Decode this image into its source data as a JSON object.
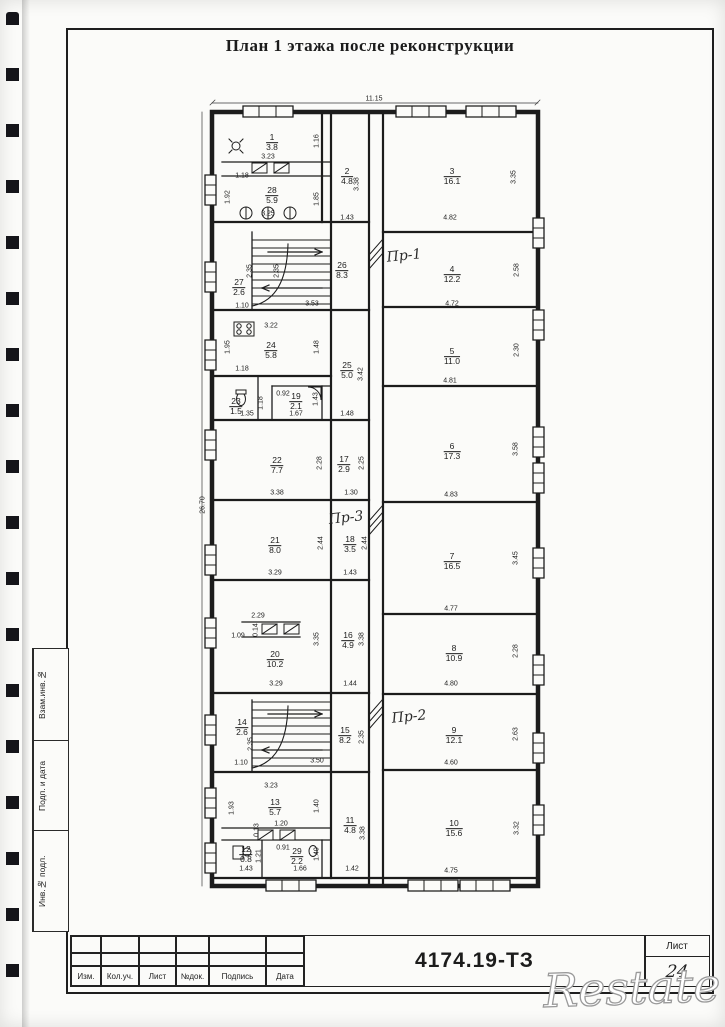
{
  "page": {
    "title": "План 1 этажа после реконструкции",
    "watermark": "Restate"
  },
  "titleblock": {
    "doc_number": "4174.19-ТЗ",
    "sheet_label": "Лист",
    "sheet_number": "24",
    "columns": [
      "Изм.",
      "Кол.уч.",
      "Лист",
      "№док.",
      "Подпись",
      "Дата"
    ]
  },
  "sidebar_stamp": {
    "labels": [
      "Взам.инв.№",
      "Подп. и дата",
      "Инв.№ подл."
    ]
  },
  "plan": {
    "overall_width_dim": "11.15",
    "overall_height_dim": "26.70",
    "annotations": [
      {
        "text": "Пр-1",
        "x": 404,
        "y": 256,
        "r": -6
      },
      {
        "text": "Пр-3",
        "x": 346,
        "y": 518,
        "r": -6
      },
      {
        "text": "Пр-2",
        "x": 409,
        "y": 717,
        "r": -6
      }
    ],
    "rooms": [
      {
        "n": "1",
        "a": "3.8",
        "x": 272,
        "y": 143
      },
      {
        "n": "2",
        "a": "4.8",
        "x": 347,
        "y": 177
      },
      {
        "n": "3",
        "a": "16.1",
        "x": 452,
        "y": 177
      },
      {
        "n": "28",
        "a": "5.9",
        "x": 272,
        "y": 196
      },
      {
        "n": "27",
        "a": "2.6",
        "x": 239,
        "y": 288
      },
      {
        "n": "26",
        "a": "8.3",
        "x": 342,
        "y": 271
      },
      {
        "n": "4",
        "a": "12.2",
        "x": 452,
        "y": 275
      },
      {
        "n": "24",
        "a": "5.8",
        "x": 271,
        "y": 351
      },
      {
        "n": "25",
        "a": "5.0",
        "x": 347,
        "y": 371
      },
      {
        "n": "5",
        "a": "11.0",
        "x": 452,
        "y": 357
      },
      {
        "n": "23",
        "a": "1.5",
        "x": 236,
        "y": 407
      },
      {
        "n": "19",
        "a": "2.1",
        "x": 296,
        "y": 402
      },
      {
        "n": "22",
        "a": "7.7",
        "x": 277,
        "y": 466
      },
      {
        "n": "17",
        "a": "2.9",
        "x": 344,
        "y": 465
      },
      {
        "n": "6",
        "a": "17.3",
        "x": 452,
        "y": 452
      },
      {
        "n": "21",
        "a": "8.0",
        "x": 275,
        "y": 546
      },
      {
        "n": "18",
        "a": "3.5",
        "x": 350,
        "y": 545
      },
      {
        "n": "7",
        "a": "16.5",
        "x": 452,
        "y": 562
      },
      {
        "n": "20",
        "a": "10.2",
        "x": 275,
        "y": 660
      },
      {
        "n": "16",
        "a": "4.9",
        "x": 348,
        "y": 641
      },
      {
        "n": "8",
        "a": "10.9",
        "x": 454,
        "y": 654
      },
      {
        "n": "14",
        "a": "2.6",
        "x": 242,
        "y": 728
      },
      {
        "n": "15",
        "a": "8.2",
        "x": 345,
        "y": 736
      },
      {
        "n": "9",
        "a": "12.1",
        "x": 454,
        "y": 736
      },
      {
        "n": "13",
        "a": "5.7",
        "x": 275,
        "y": 808
      },
      {
        "n": "11",
        "a": "4.8",
        "x": 350,
        "y": 826
      },
      {
        "n": "12",
        "a": "0.8",
        "x": 246,
        "y": 855
      },
      {
        "n": "29",
        "a": "2.2",
        "x": 297,
        "y": 857
      },
      {
        "n": "10",
        "a": "15.6",
        "x": 454,
        "y": 829
      }
    ],
    "dims": [
      {
        "t": "11.15",
        "x": 374,
        "y": 99
      },
      {
        "t": "26.70",
        "x": 203,
        "y": 505,
        "r": -90
      },
      {
        "t": "3.23",
        "x": 268,
        "y": 157
      },
      {
        "t": "1.16",
        "x": 317,
        "y": 141,
        "r": -90
      },
      {
        "t": "1.18",
        "x": 242,
        "y": 176
      },
      {
        "t": "1.92",
        "x": 228,
        "y": 197,
        "r": -90
      },
      {
        "t": "1.85",
        "x": 317,
        "y": 199,
        "r": -90
      },
      {
        "t": "3.25",
        "x": 268,
        "y": 214
      },
      {
        "t": "3.38",
        "x": 357,
        "y": 184,
        "r": -90
      },
      {
        "t": "1.43",
        "x": 347,
        "y": 218
      },
      {
        "t": "4.82",
        "x": 450,
        "y": 218
      },
      {
        "t": "3.35",
        "x": 514,
        "y": 177,
        "r": -90
      },
      {
        "t": "2.35",
        "x": 250,
        "y": 271,
        "r": -90
      },
      {
        "t": "2.35",
        "x": 277,
        "y": 271,
        "r": -90
      },
      {
        "t": "1.10",
        "x": 242,
        "y": 306
      },
      {
        "t": "3.53",
        "x": 312,
        "y": 304
      },
      {
        "t": "4.72",
        "x": 452,
        "y": 304
      },
      {
        "t": "2.58",
        "x": 517,
        "y": 270,
        "r": -90
      },
      {
        "t": "3.22",
        "x": 271,
        "y": 326
      },
      {
        "t": "1.95",
        "x": 228,
        "y": 347,
        "r": -90
      },
      {
        "t": "1.48",
        "x": 317,
        "y": 347,
        "r": -90
      },
      {
        "t": "1.18",
        "x": 242,
        "y": 369
      },
      {
        "t": "3.42",
        "x": 361,
        "y": 374,
        "r": -90
      },
      {
        "t": "4.81",
        "x": 450,
        "y": 381
      },
      {
        "t": "2.30",
        "x": 517,
        "y": 350,
        "r": -90
      },
      {
        "t": "1.35",
        "x": 247,
        "y": 414
      },
      {
        "t": "1.18",
        "x": 261,
        "y": 403,
        "r": -90
      },
      {
        "t": "0.92",
        "x": 283,
        "y": 394
      },
      {
        "t": "1.67",
        "x": 296,
        "y": 414
      },
      {
        "t": "1.43",
        "x": 316,
        "y": 399,
        "r": -90
      },
      {
        "t": "1.48",
        "x": 347,
        "y": 414
      },
      {
        "t": "2.28",
        "x": 320,
        "y": 463,
        "r": -90
      },
      {
        "t": "2.25",
        "x": 362,
        "y": 463,
        "r": -90
      },
      {
        "t": "3.38",
        "x": 277,
        "y": 493
      },
      {
        "t": "1.30",
        "x": 351,
        "y": 493
      },
      {
        "t": "4.83",
        "x": 451,
        "y": 495
      },
      {
        "t": "3.58",
        "x": 516,
        "y": 449,
        "r": -90
      },
      {
        "t": "2.44",
        "x": 321,
        "y": 543,
        "r": -90
      },
      {
        "t": "2.44",
        "x": 365,
        "y": 543,
        "r": -90
      },
      {
        "t": "3.29",
        "x": 275,
        "y": 573
      },
      {
        "t": "1.43",
        "x": 350,
        "y": 573
      },
      {
        "t": "3.45",
        "x": 516,
        "y": 558,
        "r": -90
      },
      {
        "t": "4.77",
        "x": 451,
        "y": 609
      },
      {
        "t": "2.29",
        "x": 258,
        "y": 616
      },
      {
        "t": "1.09",
        "x": 238,
        "y": 636
      },
      {
        "t": "0.14",
        "x": 256,
        "y": 630,
        "r": -90
      },
      {
        "t": "3.35",
        "x": 317,
        "y": 639,
        "r": -90
      },
      {
        "t": "3.38",
        "x": 362,
        "y": 639,
        "r": -90
      },
      {
        "t": "3.29",
        "x": 276,
        "y": 684
      },
      {
        "t": "1.44",
        "x": 350,
        "y": 684
      },
      {
        "t": "2.28",
        "x": 516,
        "y": 651,
        "r": -90
      },
      {
        "t": "4.80",
        "x": 451,
        "y": 684
      },
      {
        "t": "2.35",
        "x": 251,
        "y": 744,
        "r": -90
      },
      {
        "t": "1.10",
        "x": 241,
        "y": 763
      },
      {
        "t": "3.50",
        "x": 317,
        "y": 761
      },
      {
        "t": "2.35",
        "x": 362,
        "y": 737,
        "r": -90
      },
      {
        "t": "2.63",
        "x": 516,
        "y": 734,
        "r": -90
      },
      {
        "t": "4.60",
        "x": 451,
        "y": 763
      },
      {
        "t": "3.23",
        "x": 271,
        "y": 786
      },
      {
        "t": "1.93",
        "x": 232,
        "y": 808,
        "r": -90
      },
      {
        "t": "1.40",
        "x": 317,
        "y": 806,
        "r": -90
      },
      {
        "t": "1.20",
        "x": 281,
        "y": 824
      },
      {
        "t": "0.13",
        "x": 257,
        "y": 830,
        "r": -90
      },
      {
        "t": "3.38",
        "x": 363,
        "y": 833,
        "r": -90
      },
      {
        "t": "0.91",
        "x": 283,
        "y": 848
      },
      {
        "t": "1.21",
        "x": 259,
        "y": 856,
        "r": -90
      },
      {
        "t": "1.40",
        "x": 317,
        "y": 854,
        "r": -90
      },
      {
        "t": "1.43",
        "x": 246,
        "y": 869
      },
      {
        "t": "1.66",
        "x": 300,
        "y": 869
      },
      {
        "t": "1.42",
        "x": 352,
        "y": 869
      },
      {
        "t": "4.75",
        "x": 451,
        "y": 871
      },
      {
        "t": "3.32",
        "x": 517,
        "y": 828,
        "r": -90
      }
    ]
  }
}
